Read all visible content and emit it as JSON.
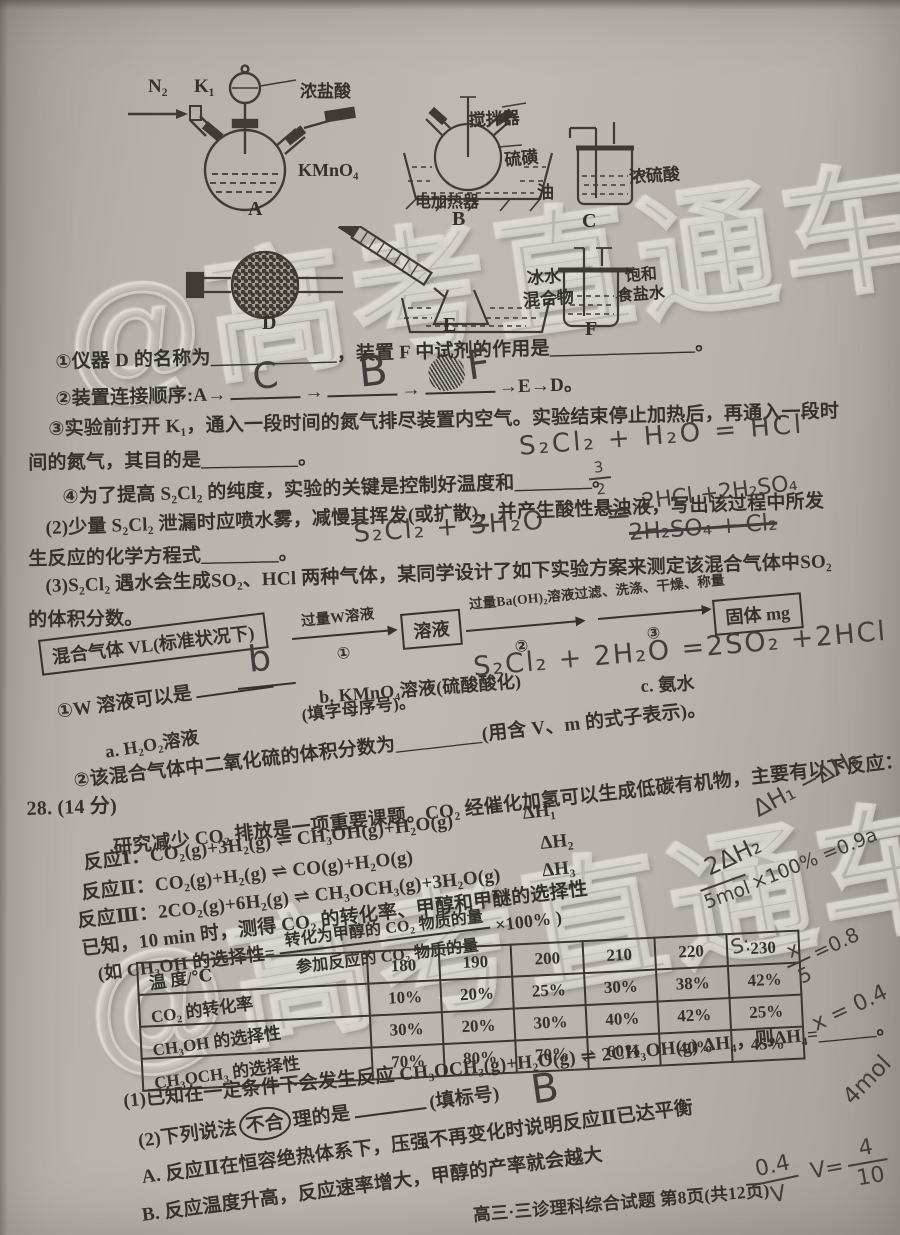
{
  "paper": {
    "watermark": "@高考直通车",
    "footer": "高三·三诊理科综合试题  第8页(共12页)"
  },
  "apparatus": {
    "a": {
      "gas_in": "N₂",
      "valve": "K₁",
      "funnel_reagent": "浓盐酸",
      "flask_reagent": "KMnO₄",
      "label": "A"
    },
    "b": {
      "stirrer": "搅拌器",
      "sulfur": "硫磺",
      "oil": "油",
      "heater": "电加热器",
      "label": "B"
    },
    "c": {
      "reagent": "浓硫酸",
      "label": "C"
    },
    "d": {
      "label": "D"
    },
    "e": {
      "bath1": "冰水",
      "bath2": "混合物",
      "label": "E"
    },
    "f": {
      "reagent1": "饱和",
      "reagent2": "食盐水",
      "label": "F"
    }
  },
  "q27": {
    "i1": "①仪器 D 的名称为_____________，装置 F 中试剂的作用是_______________。",
    "i2_prefix": "②装置连接顺序:A→",
    "i2_arrow": "→",
    "i2_suffix": "→E→D。",
    "i3a": "③实验前打开 K₁，通入一段时间的氮气排尽装置内空气。实验结束停止加热后，再通入一段时",
    "i3b": "间的氮气，其目的是__________。",
    "i4": "④为了提高 S₂Cl₂ 的纯度，实验的关键是控制好温度和________。",
    "p2a": "(2)少量 S₂Cl₂ 泄漏时应喷水雾，减慢其挥发(或扩散)，并产生酸性悬浊液，写出该过程中所发",
    "p2b": "生反应的化学方程式________。",
    "p3a": "(3)S₂Cl₂ 遇水会生成SO₂、HCl 两种气体，某同学设计了如下实验方案来测定该混合气体中SO₂",
    "p3b": "的体积分数。",
    "flow": {
      "box_mix": "混合气体 VL(标准状况下)",
      "step1_label": "过量W溶液",
      "step1_num": "①",
      "box_solution": "溶液",
      "step2_label": "过量Ba(OH)₂溶液过滤、洗涤、干燥、称量",
      "step2_num": "②",
      "step3_num": "③",
      "box_solid": "固体 mg"
    },
    "w_q": "①W 溶液可以是",
    "w_hint": "(填字母序号)。",
    "opt_a": "a. H₂O₂溶液",
    "opt_b": "b. KMnO₄溶液(硫酸酸化)",
    "opt_c": "c. 氨水",
    "frac_q": "②该混合气体中二氧化硫的体积分数为_________(用含 V、m 的式子表示)。"
  },
  "q28": {
    "num": "28. (14 分)",
    "intro": "研究减少 CO₂ 排放是一项重要课题。CO₂ 经催化加氢可以生成低碳有机物，主要有以下反应：",
    "r1": "反应Ⅰ：CO₂(g)+3H₂(g) ⇌ CH₃OH(g)+H₂O(g)",
    "r1_dh": "ΔH₁",
    "r2": "反应Ⅱ：CO₂(g)+H₂(g) ⇌ CO(g)+H₂O(g)",
    "r2_dh": "ΔH₂",
    "r3": "反应Ⅲ：2CO₂(g)+6H₂(g) ⇌ CH₃OCH₃(g)+3H₂O(g)",
    "r3_dh": "ΔH₃",
    "known": "已知，10 min 时，测得 CO₂ 的转化率、甲醇和甲醚的选择性",
    "sel_prefix": "(如 CH₃OH 的选择性=",
    "sel_num": "转化为甲醇的 CO₂ 物质的量",
    "sel_den": "参加反应的 CO₂ 物质的量",
    "sel_suffix": "×100% )",
    "q1": "(1)已知在一定条件下会发生反应 CH₃OCH₃(g)+H₂O(g) ⇌ 2CH₃OH(g)  ΔH₄，则ΔH₄=______。",
    "q2_pre": "(2)下列说法",
    "q2_circled": "不合",
    "q2_post": "理的是",
    "q2_hint": "(填标号)",
    "optA": "A. 反应Ⅱ在恒容绝热体系下，压强不再变化时说明反应Ⅱ已达平衡",
    "optB": "B. 反应温度升高，反应速率增大，甲醇的产率就会越大"
  },
  "table": {
    "corner": "温  度/℃",
    "temps": [
      "180",
      "190",
      "200",
      "210",
      "220",
      "230"
    ],
    "rows": [
      {
        "label": "CO₂ 的转化率",
        "values": [
          "10%",
          "20%",
          "25%",
          "30%",
          "38%",
          "42%"
        ]
      },
      {
        "label": "CH₃OH 的选择性",
        "values": [
          "30%",
          "20%",
          "30%",
          "40%",
          "42%",
          "25%"
        ]
      },
      {
        "label": "CH₃OCH₃ 的选择性",
        "values": [
          "70%",
          "80%",
          "70%",
          "60%",
          "40%",
          "45%"
        ]
      }
    ]
  },
  "chart_data": {
    "type": "table",
    "title": "",
    "xlabel": "温度/℃",
    "categories": [
      180,
      190,
      200,
      210,
      220,
      230
    ],
    "series": [
      {
        "name": "CO₂ 的转化率",
        "values": [
          "10%",
          "20%",
          "25%",
          "30%",
          "38%",
          "42%"
        ]
      },
      {
        "name": "CH₃OH 的选择性",
        "values": [
          "30%",
          "20%",
          "30%",
          "40%",
          "42%",
          "25%"
        ]
      },
      {
        "name": "CH₃OCH₃ 的选择性",
        "values": [
          "70%",
          "80%",
          "70%",
          "60%",
          "40%",
          "45%"
        ]
      }
    ]
  },
  "handwriting": {
    "seq1": "C",
    "seq2": "B",
    "seq3": "F",
    "eq1": "S₂Cl₂ + H₂O = HCl",
    "coef_num": "3",
    "coef_den": "2",
    "eq2_left": "S₂Cl₂ +",
    "eq2_scribble": "3",
    "eq2_mid": "H₂O",
    "eq2_eq": "=",
    "eq2_top": "2HCl +2H₂SO₄",
    "eq2_crossed": "2H₂SO₄ + Cl₂",
    "ans_b": "b",
    "eq3": "S₂Cl₂ + 2H₂O =2SO₂ +2HCl",
    "dh13": "ΔH₁ −ΔH₃",
    "dh2": "2ΔH₂",
    "calc_pct": "×100% =0.9a",
    "calc_mol": "5mol",
    "s_label": "S:",
    "frac1_num": "x",
    "frac1_den": "5",
    "frac1_eq": "=0.8",
    "x_val": "x = 0.4",
    "mol4": "4mol",
    "frac2_num": "0.4",
    "frac2_den": "V",
    "v_label": "V=",
    "frac3_num": "4",
    "frac3_den": "10",
    "ans_B": "B"
  }
}
